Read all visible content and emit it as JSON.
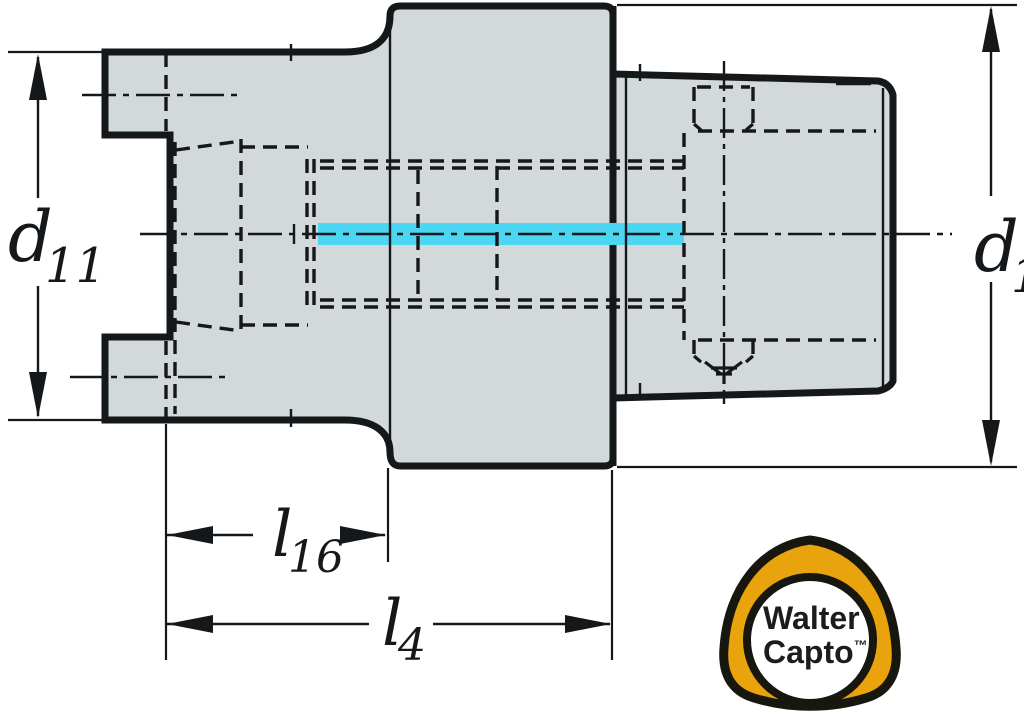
{
  "dimensions": {
    "d11": {
      "symbol": "d",
      "subscript": "11"
    },
    "d1": {
      "symbol": "d",
      "subscript": "1"
    },
    "l16": {
      "symbol": "l",
      "subscript": "16"
    },
    "l4": {
      "symbol": "l",
      "subscript": "4"
    }
  },
  "logo": {
    "line1": "Walter",
    "line2": "Capto",
    "trademark": "™"
  },
  "colors": {
    "background": "#FFFFFF",
    "part_fill": "#D3D8D8",
    "line": "#15181A",
    "coolant_highlight": "#4BD7F2",
    "logo_orange": "#E9A30D",
    "logo_ring": "#18170F",
    "logo_inner": "#FFFFFF",
    "logo_text": "#1C1C1A"
  }
}
